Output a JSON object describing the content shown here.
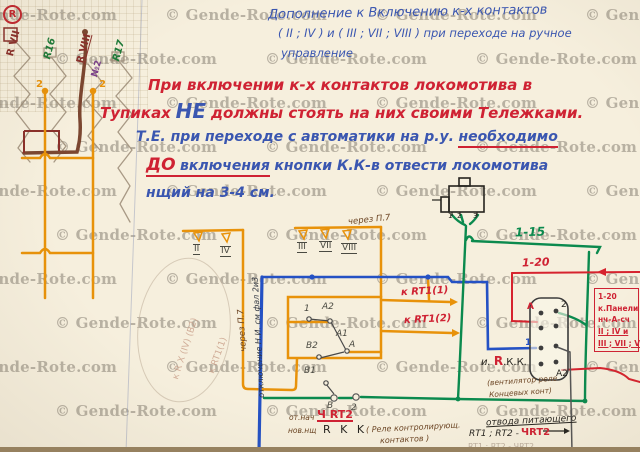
{
  "watermark": {
    "text": "© Gende-Rote.com",
    "logo_letter": "R"
  },
  "header_note": {
    "line1": "Дополнение к Включению к-х контактов",
    "line2": "( II ; IV )  и  ( III ; VII ; VIII )  при переходе на ручное",
    "line3": "управление"
  },
  "main_note": {
    "l1": "При включении к-х контактов локомотива в",
    "l2_red1": "Тупиках",
    "l2_blue": "НЕ",
    "l2_red2": "должны стоять на них своими Тележками.",
    "l3_blue": "Т.Е. при переходе с автоматики на р.у.",
    "l3_underlined": "необходимо",
    "l4_red": "ДО",
    "l4_blue1": "включения",
    "l4_blue2": "кнопки К.К-в отвести локомотива",
    "l5": "нщий на 3-4 см."
  },
  "top_left_labels": {
    "rvii": "R VII",
    "r16": "R16",
    "rviii": "R VIII",
    "n2": "№2",
    "r17": "R17",
    "w2a": "2",
    "w2b": "2"
  },
  "contact_groups": {
    "left": [
      "II",
      "IV"
    ],
    "right": [
      "III",
      "VII",
      "VIII"
    ],
    "via_note": "через П.7"
  },
  "wire_notes": {
    "via_p7": "через П.7",
    "otkl": "отключение Н.И. см фал 2и3"
  },
  "pencil_notes": {
    "t1": "к R X (IV) (B2)",
    "t2": "к RT1(1)",
    "bottom": "RT1 ; RT2 - ЧRT2"
  },
  "switch_labels": {
    "p1": "1",
    "a2": "A2",
    "a1": "A1",
    "a": "A",
    "b2": "B2",
    "b1": "B1",
    "b": "B",
    "p2": "2"
  },
  "arrow_labels": {
    "rt1_1": "к RT1(1)",
    "rt1_2": "к RT1(2)"
  },
  "right_side": {
    "green": "1-15",
    "red": "1-20",
    "box_lines": [
      "1-20",
      "к.Панели",
      "нч-А-сч",
      "II ; IV  и",
      "III ; VII ; VIII"
    ]
  },
  "connector_pins": {
    "a": "A",
    "n2": "2",
    "n1": "1",
    "a2": "A2"
  },
  "device_pins": [
    "1",
    "2",
    "3"
  ],
  "rkk": {
    "prefix": "и.",
    "r": "R",
    "suffix": ".К.К.",
    "note1": "(вентилятор реле",
    "note2": "Концевых конт)"
  },
  "bottom_notes": {
    "ot_nach": "от.нач",
    "ch_rt2": "Ч RT2",
    "nov": "нов.нщ",
    "rkk": "R K K",
    "note1": "( Реле контролирующ.",
    "note2": "контактов )",
    "otvod1": "отвода питающего",
    "otvod2": "RT1 ; RT2 -",
    "otvod_red": "ЧRT2"
  }
}
